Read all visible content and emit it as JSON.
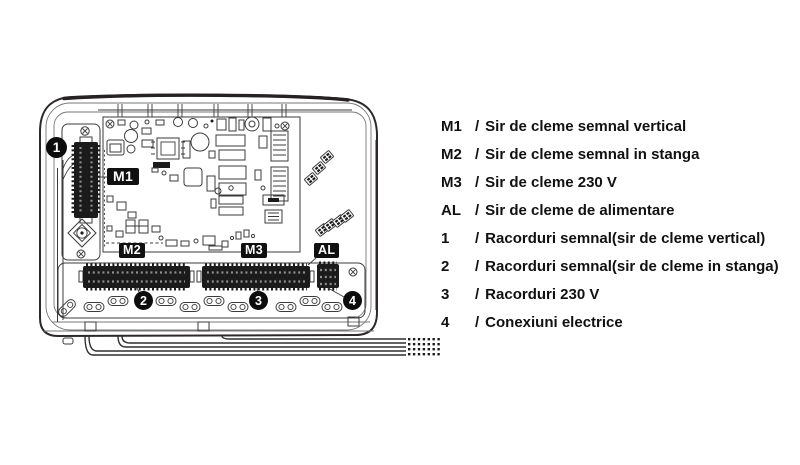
{
  "diagram": {
    "badges": [
      {
        "text": "M1"
      },
      {
        "text": "M2"
      },
      {
        "text": "M3"
      },
      {
        "text": "AL"
      }
    ],
    "callouts": [
      {
        "text": "1"
      },
      {
        "text": "2"
      },
      {
        "text": "3"
      },
      {
        "text": "4"
      }
    ]
  },
  "legend": {
    "items": [
      {
        "key": "M1",
        "sep": "/",
        "text": "Sir de cleme semnal vertical"
      },
      {
        "key": "M2",
        "sep": "/",
        "text": "Sir de cleme semnal in stanga"
      },
      {
        "key": "M3",
        "sep": "/",
        "text": "Sir de cleme 230 V"
      },
      {
        "key": "AL",
        "sep": "/",
        "text": "Sir de cleme de alimentare"
      },
      {
        "key": "1",
        "sep": "/",
        "text": "Racorduri semnal(sir de cleme vertical)"
      },
      {
        "key": "2",
        "sep": "/",
        "text": "Racorduri semnal(sir de cleme in stanga)"
      },
      {
        "key": "3",
        "sep": "/",
        "text": "Racorduri 230 V"
      },
      {
        "key": "4",
        "sep": "/",
        "text": "Conexiuni electrice"
      }
    ]
  },
  "colors": {
    "label_bg": "#101010",
    "label_fg": "#ffffff",
    "line": "#3b3b3b",
    "text": "#111111"
  }
}
